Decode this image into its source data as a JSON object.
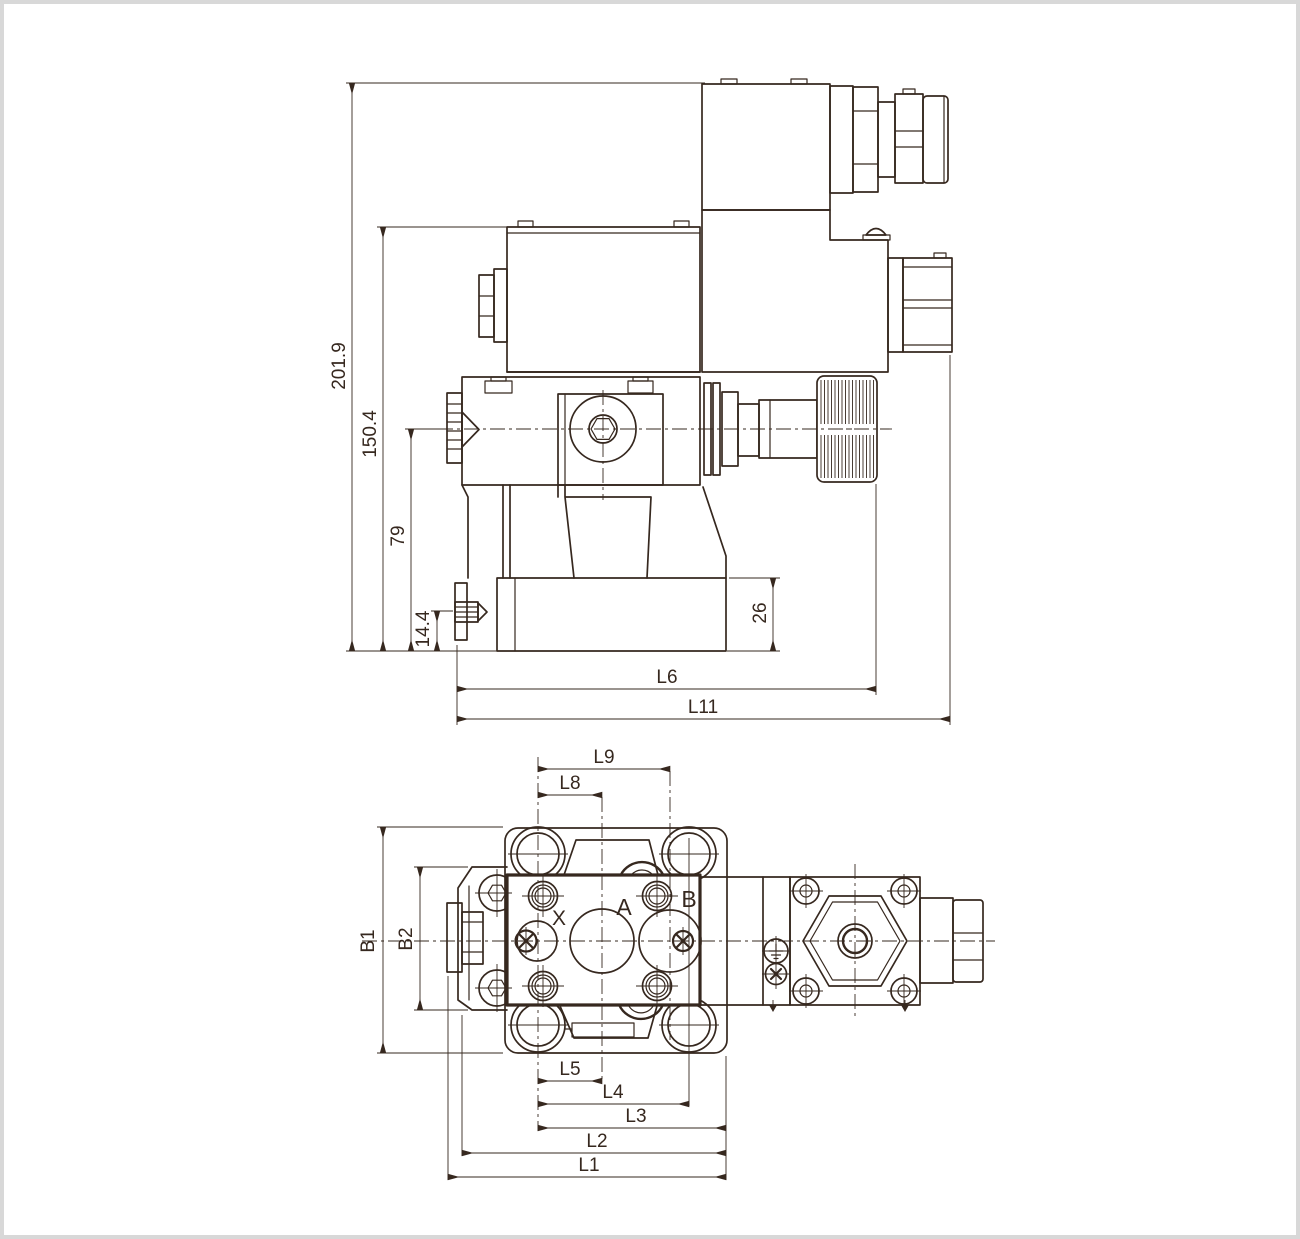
{
  "colors": {
    "line": "#36281f",
    "background": "#ffffff",
    "frame": "#d8d8d8"
  },
  "side_view": {
    "dims": {
      "overall_height": "201.9",
      "coil_top_height": "150.4",
      "centerline_height": "79",
      "drain_plug_height": "14.4",
      "base_height": "26",
      "length_to_knob": "L6",
      "overall_length": "L11"
    }
  },
  "plan_view": {
    "dims": {
      "l9": "L9",
      "l8": "L8",
      "b1": "B1",
      "b2": "B2",
      "l5": "L5",
      "l4": "L4",
      "l3": "L3",
      "l2": "L2",
      "l1": "L1"
    },
    "ports": {
      "x": "X",
      "a": "A",
      "b": "B"
    }
  }
}
